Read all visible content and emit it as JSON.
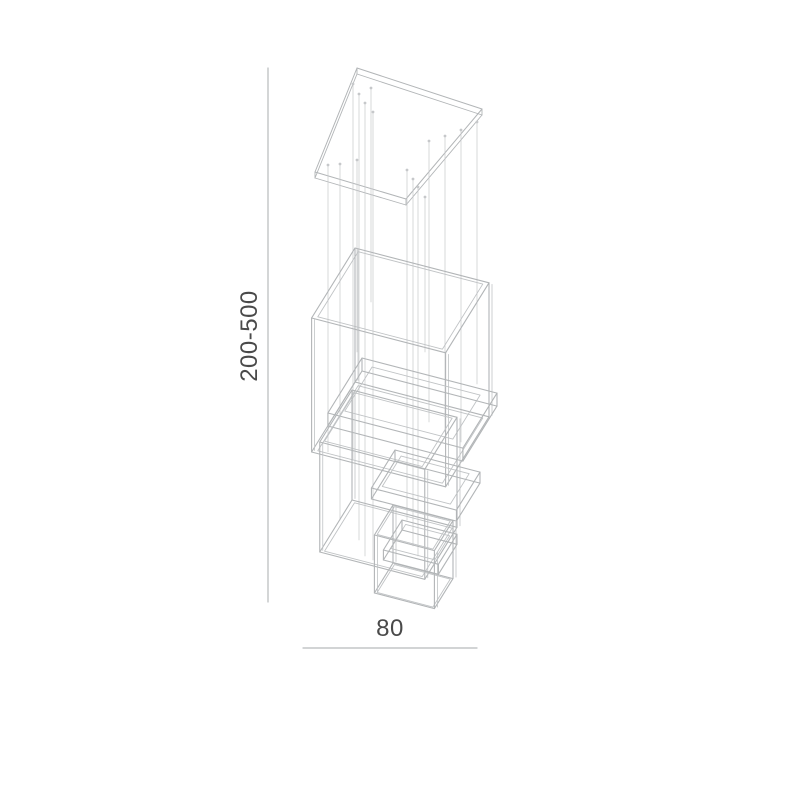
{
  "page": {
    "background_color": "#ffffff",
    "description": "Technical dimension line drawing of a cascading cube pendant lamp"
  },
  "dimensions": {
    "height_label": "200-500",
    "width_label": "80"
  },
  "drawing": {
    "line_color": "#b2b5b7",
    "inner_line_color": "#c0c3c5",
    "wire_color": "#c6c8ca",
    "dim_line_color": "#b7babc",
    "text_color": "#4a4a4a",
    "canopy": {
      "quad": [
        [
          357,
          68
        ],
        [
          482,
          109
        ],
        [
          406,
          199
        ],
        [
          315,
          172
        ]
      ],
      "thickness": 6
    },
    "wires": [
      [
        328,
        165,
        452
      ],
      [
        340,
        164,
        520
      ],
      [
        353,
        84,
        460
      ],
      [
        359,
        94,
        540
      ],
      [
        365,
        103,
        556
      ],
      [
        373,
        112,
        560
      ],
      [
        357,
        160,
        352
      ],
      [
        371,
        88,
        302
      ],
      [
        407,
        170,
        520
      ],
      [
        413,
        179,
        546
      ],
      [
        418,
        187,
        556
      ],
      [
        425,
        197,
        352
      ],
      [
        429,
        141,
        422
      ],
      [
        445,
        136,
        432
      ],
      [
        461,
        130,
        442
      ],
      [
        477,
        122,
        384
      ]
    ],
    "boxes": [
      {
        "o": [
          355,
          248
        ],
        "w": 134,
        "d": 70,
        "h": 134
      },
      {
        "o": [
          362,
          358
        ],
        "w": 135,
        "d": 55,
        "h": 13
      },
      {
        "o": [
          352,
          390
        ],
        "w": 105,
        "d": 52,
        "h": 110
      },
      {
        "o": [
          395,
          450
        ],
        "w": 85,
        "d": 38,
        "h": 11
      },
      {
        "o": [
          393,
          505
        ],
        "w": 60,
        "d": 30,
        "h": 58
      },
      {
        "o": [
          402,
          520
        ],
        "w": 55,
        "d": 30,
        "h": 10
      }
    ],
    "dim_vertical": {
      "x": 268,
      "y1": 68,
      "y2": 602
    },
    "dim_horizontal": {
      "y": 648,
      "x1": 303,
      "x2": 477
    }
  }
}
